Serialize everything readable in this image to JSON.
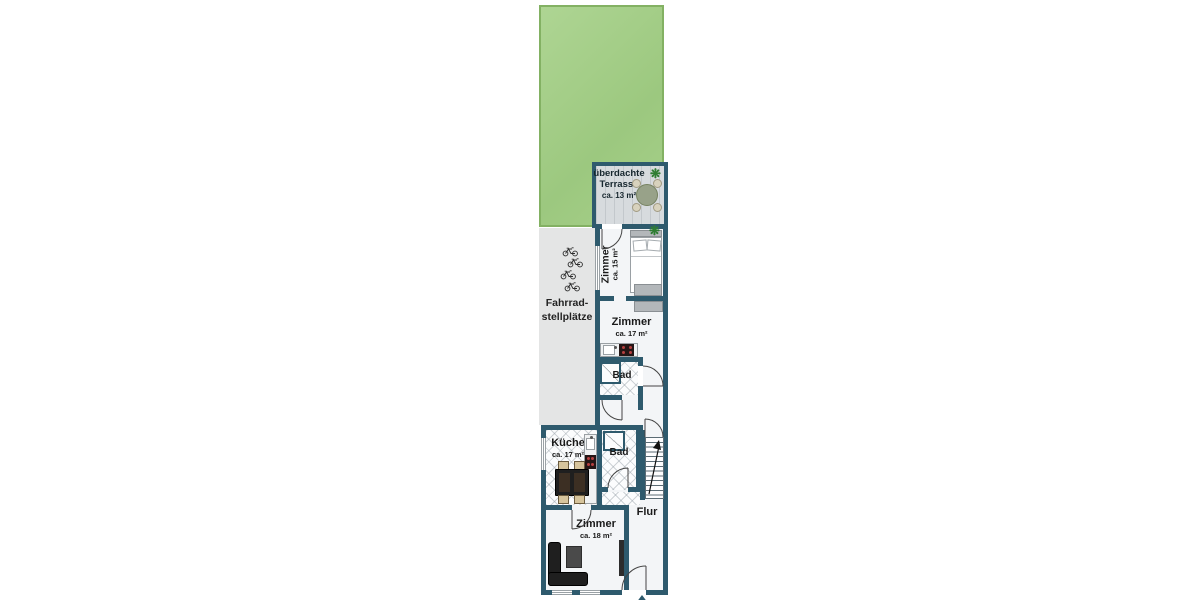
{
  "plan_type": "floor-plan",
  "terrace": {
    "line1": "überdachte",
    "line2": "Terrasse",
    "area": "ca. 13 m²"
  },
  "bike_area": {
    "line1": "Fahrrad-",
    "line2": "stellplätze"
  },
  "rooms": {
    "zimmer15": {
      "name": "Zimmer",
      "area": "ca. 15 m²"
    },
    "zimmer17": {
      "name": "Zimmer",
      "area": "ca. 17 m²"
    },
    "bad_upper": {
      "name": "Bad"
    },
    "kueche": {
      "name": "Küche",
      "area": "ca. 17 m²"
    },
    "bad_lower": {
      "name": "Bad"
    },
    "flur": {
      "name": "Flur"
    },
    "zimmer18": {
      "name": "Zimmer",
      "area": "ca. 18 m²"
    }
  },
  "icons": {
    "plant-icon": "❋",
    "bicycle-icon": "bicycle-glyph",
    "entrance-arrow-icon": "triangle-up",
    "stairs-arrow-icon": "diagonal-up-arrow"
  },
  "colors": {
    "wall": "#2e5a6d",
    "garden": "#a9d18d",
    "garden_border": "#83b163",
    "floor": "#f3f5f7",
    "bike_area_bg": "#e4e5e5",
    "terrace_wood": "#d7dbde",
    "furniture_gray": "#b3b7ba",
    "dark_furniture": "#1f1f1f",
    "stove_burner": "#b54040",
    "chair_tan": "#d6c49c"
  }
}
